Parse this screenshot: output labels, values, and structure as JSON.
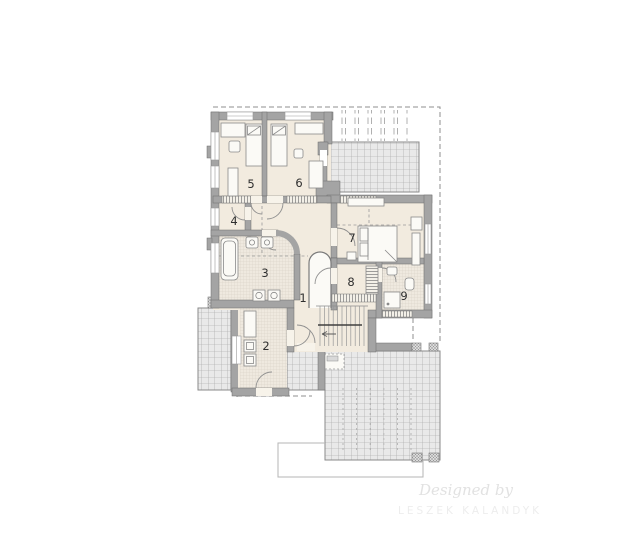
{
  "watermark": {
    "designed_by": "Designed by",
    "author": "LESZEK KALANDYK"
  },
  "rooms": [
    {
      "number": "1"
    },
    {
      "number": "2"
    },
    {
      "number": "3"
    },
    {
      "number": "4"
    },
    {
      "number": "5"
    },
    {
      "number": "6"
    },
    {
      "number": "7"
    },
    {
      "number": "8"
    },
    {
      "number": "9"
    }
  ],
  "palette": {
    "floor": "#f2ebdf",
    "wall": "#a4a4a4",
    "tile_line": "#cfc8bb",
    "terrace_fill": "#e9e9e9",
    "terrace_line": "#9f9f9f",
    "dash_line": "#8f8f8f",
    "label_text": "#2e2e2e",
    "watermark_text": "#e2e2e2"
  }
}
